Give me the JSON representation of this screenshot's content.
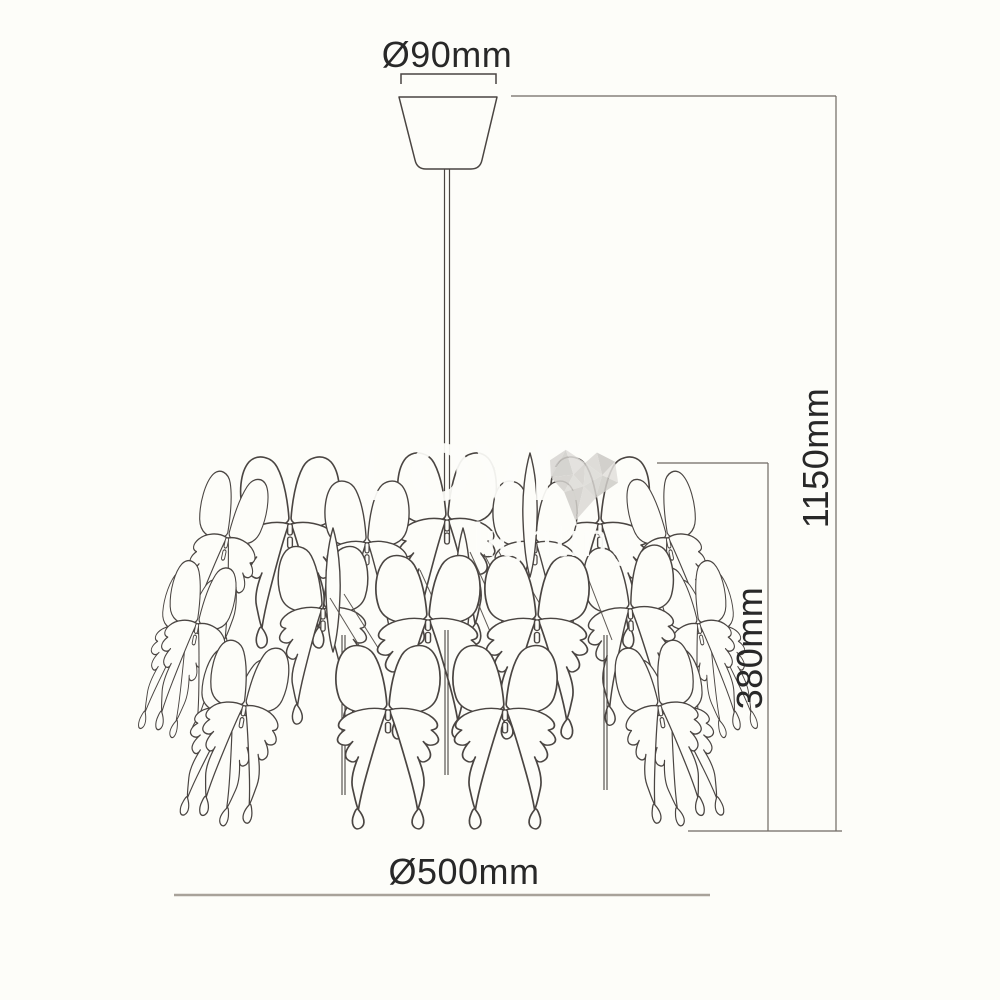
{
  "drawing": {
    "labels": {
      "canopy_diameter": "Ø90mm",
      "overall_height": "1150mm",
      "shade_height": "380mm",
      "shade_diameter": "Ø500mm"
    },
    "watermark": {
      "line1": "LOVE",
      "line2": "lighting"
    },
    "figure": {
      "subject": "butterfly pendant chandelier technical line drawing"
    },
    "colors": {
      "background": "#fdfdf9",
      "line_art": "#4a4542",
      "dimension_lines": "#6f6a63",
      "dimension_text": "#282828",
      "baseline_gray": "#a8a29a",
      "watermark_white": "rgba(253,253,250,0.93)",
      "watermark_heart": "#d6d4d0"
    }
  }
}
